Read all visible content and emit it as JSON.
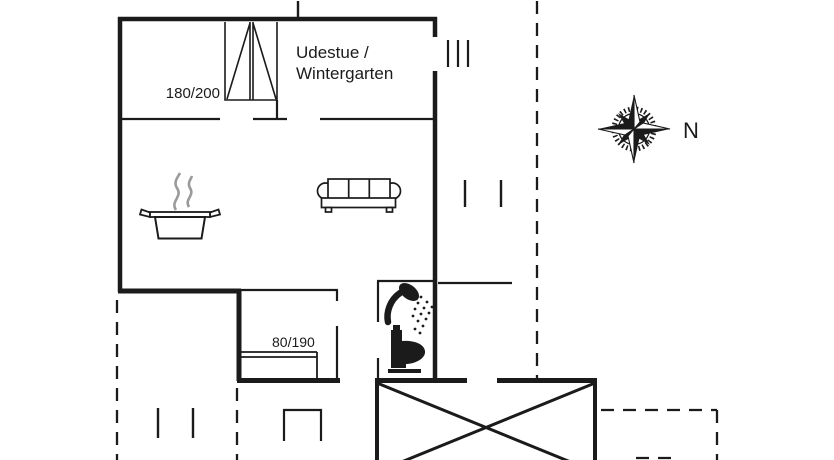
{
  "plan": {
    "rooms": {
      "winter_garden": {
        "label": "Udestue /\nWintergarten"
      }
    },
    "dimensions": {
      "window": "180/200",
      "bed": "80/190"
    },
    "compass": {
      "north": "N"
    }
  },
  "icons": {
    "compass_rose": "compass-rose-icon",
    "cooking_pot": "cooking-pot-icon",
    "sofa": "sofa-icon",
    "shower": "shower-icon",
    "toilet": "toilet-icon",
    "window_symbol": "window-icon",
    "bed_symbol": "bed-icon",
    "entrance_steps": "entrance-steps-icon"
  },
  "colors": {
    "line": "#1b1b1b",
    "steam": "#9a9a9a",
    "background": "#ffffff"
  }
}
